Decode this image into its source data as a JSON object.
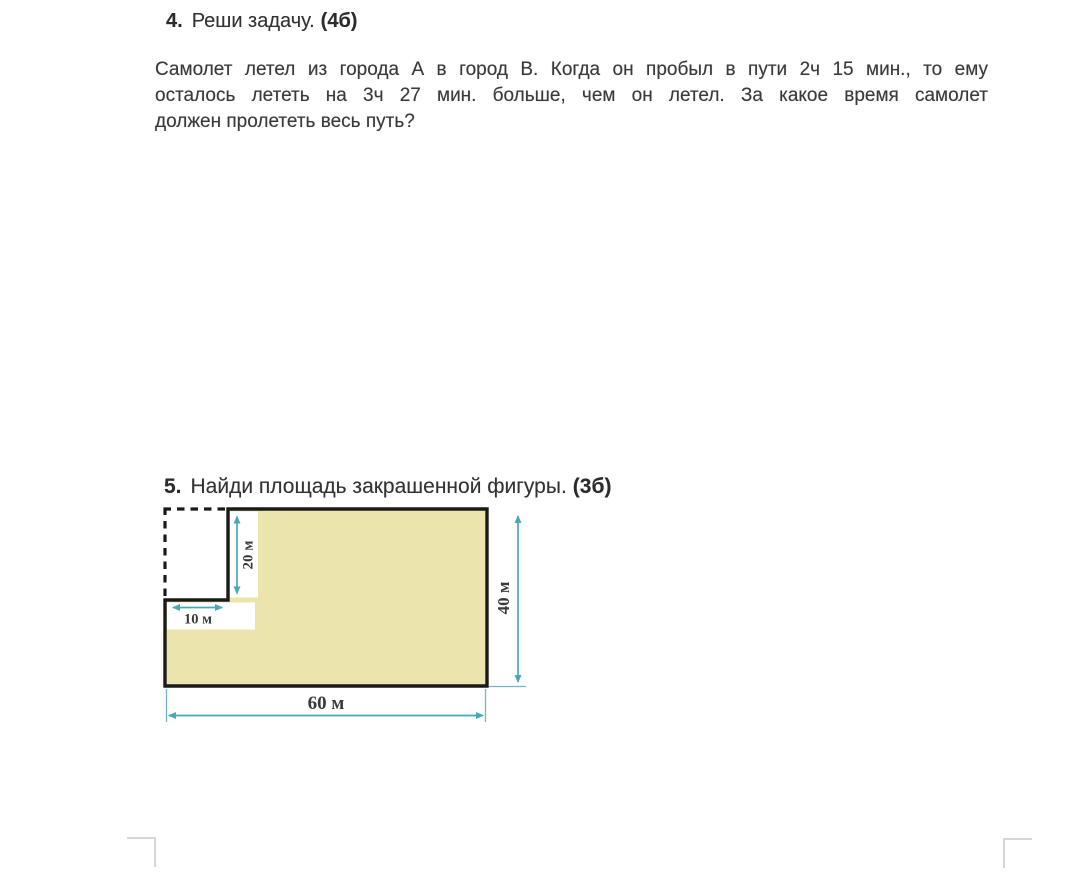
{
  "problem4": {
    "number": "4.",
    "title": "Реши задачу.",
    "points": "(4б)",
    "body_lines": [
      "Самолет летел из города А в город В. Когда он пробыл в пути 2ч 15 мин., то ему",
      "осталось лететь на 3ч 27 мин. больше, чем он летел. За какое время самолет",
      "должен пролететь весь путь?"
    ]
  },
  "problem5": {
    "number": "5.",
    "title": "Найди площадь закрашенной фигуры.",
    "points": "(3б)"
  },
  "diagram": {
    "type": "shaded-area-figure",
    "description": "Rectangle 60 м × 40 м with a 10 м × 20 м notch cut out of the top-left corner; cut-out edges shown dashed",
    "fill_color": "#ece4ad",
    "outline_color": "#1a1a1a",
    "dimension_color": "#46a9b9",
    "dimensions_m": {
      "width": 60,
      "height": 40,
      "cut_width": 10,
      "cut_height": 20
    },
    "labels": {
      "cut_height": "20 м",
      "cut_width": "10 м",
      "right_side": "40 м",
      "bottom_side": "60 м"
    }
  }
}
